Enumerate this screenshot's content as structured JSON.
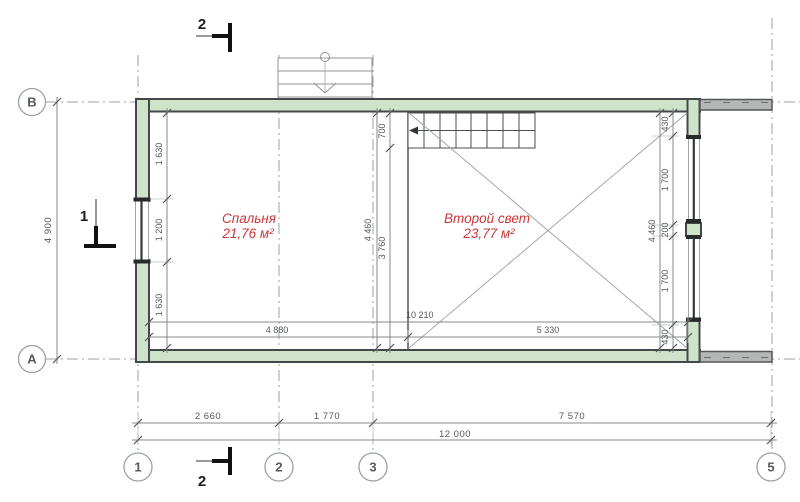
{
  "drawing": {
    "title": "floor plan level 2",
    "rooms": [
      {
        "name": "Спальня",
        "area": "21,76 м²"
      },
      {
        "name": "Второй свет",
        "area": "23,77 м²"
      }
    ],
    "grid_bubbles": {
      "row_top": "В",
      "row_bottom": "А",
      "col_1": "1",
      "col_2": "2",
      "col_3": "3",
      "col_5": "5"
    },
    "section_markers": {
      "top": "2",
      "bottom": "2",
      "left": "1"
    },
    "dims": {
      "overall_height": "4 900",
      "overall_width": "12 000",
      "span_1_2": "2 660",
      "span_2_3": "1 770",
      "span_3_5": "7 570",
      "left_chain": [
        "1 630",
        "1 200",
        "1 630"
      ],
      "interior_height_mid": "4 460",
      "stair_top": "700",
      "stair_rest": "3 760",
      "interior_height_right": "4 460",
      "right_chain": [
        "430",
        "1 700",
        "200",
        "1 700",
        "430"
      ],
      "interior_width": "10 210",
      "bedroom_width": "4 880",
      "second_light_width": "5 330"
    },
    "colors": {
      "wall_fill": "#cfe3ca",
      "wall_line": "#45484b",
      "cut_wall_fill": "#b5b6b6",
      "grid_line": "#9ba1a5",
      "dimension": "#54575a",
      "room_label": "#ca373b"
    }
  }
}
